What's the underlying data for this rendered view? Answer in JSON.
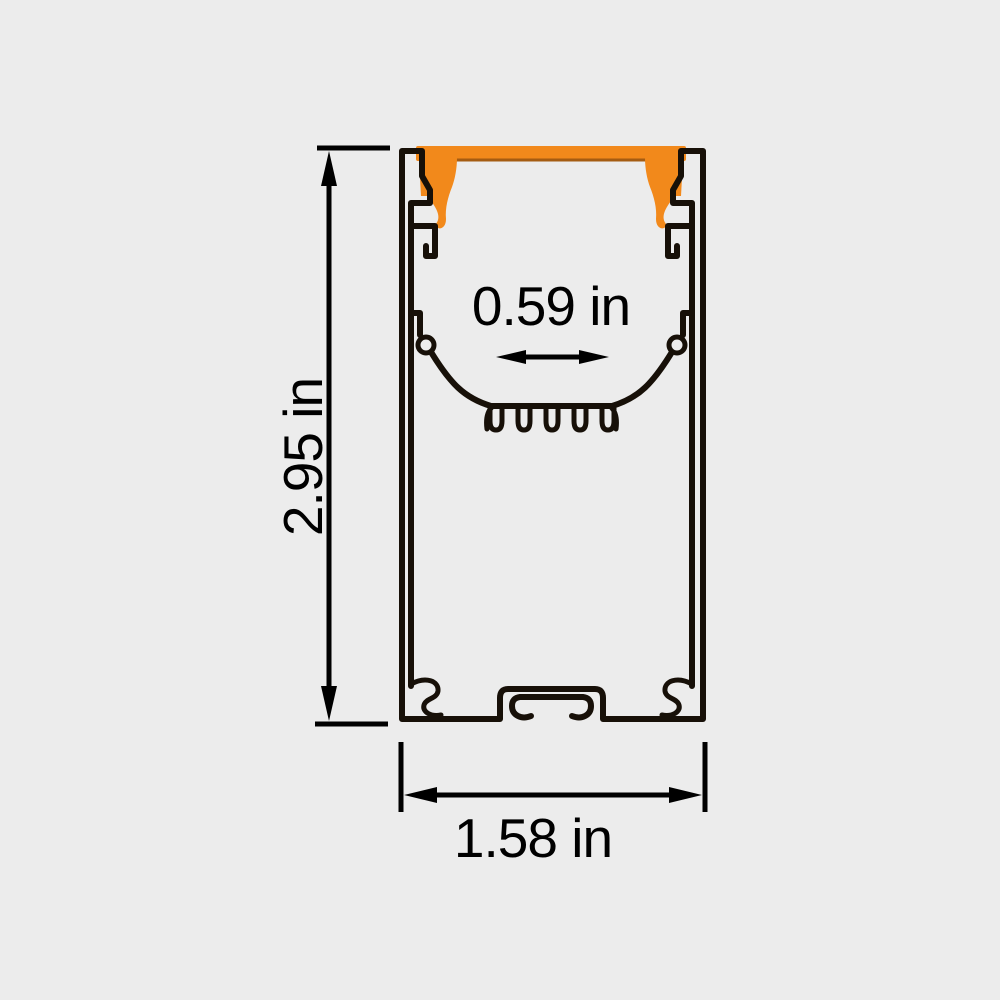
{
  "diagram": {
    "colors": {
      "background": "#ececec",
      "line": "#171008",
      "dimension": "#000000",
      "accent": "#f2891b",
      "accent_edge": "#a55c12"
    },
    "labels": {
      "height": "2.95 in",
      "width": "1.58 in",
      "inner_width": "0.59 in"
    }
  }
}
